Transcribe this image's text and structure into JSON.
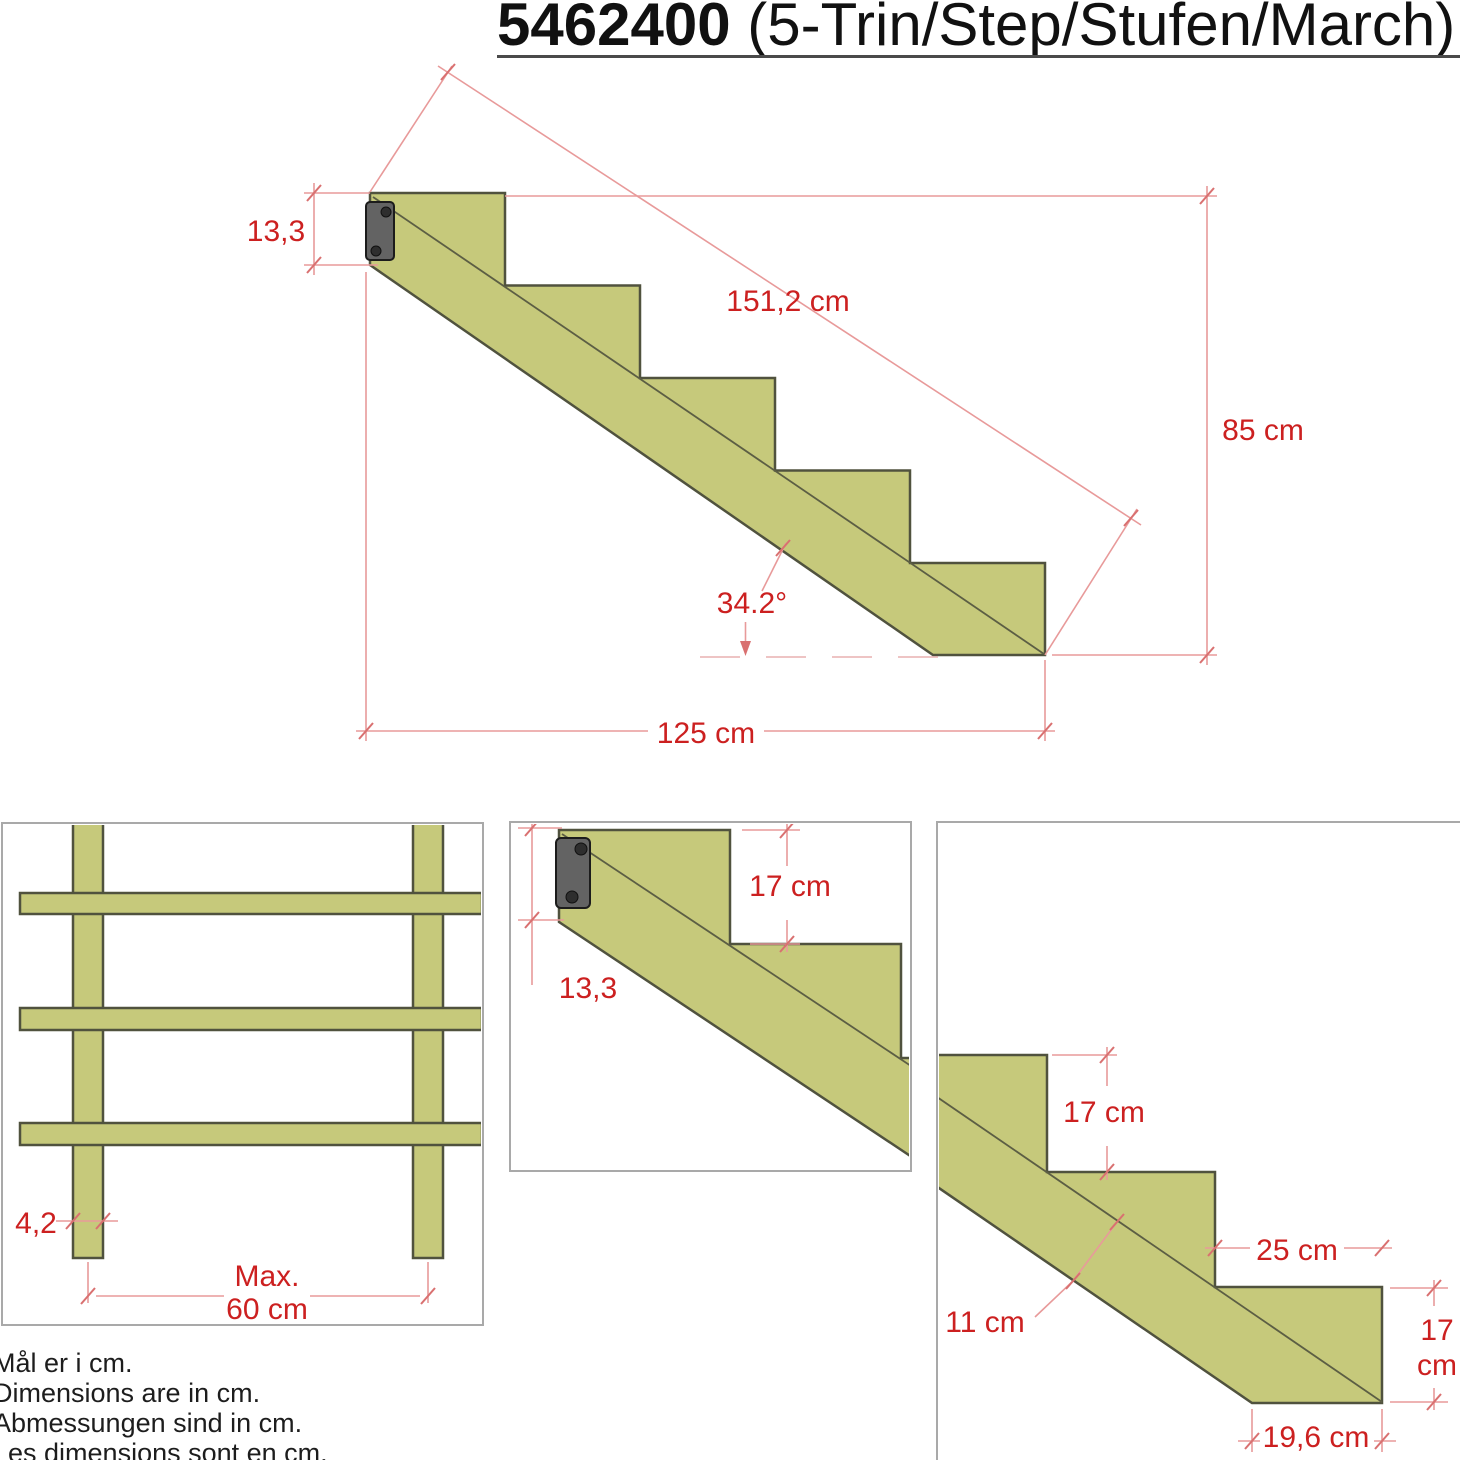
{
  "title": {
    "code": "5462400",
    "variant": " (5-Trin/Step/Stufen/March)"
  },
  "main_view": {
    "bracket_offset": "13,3",
    "slope_length": "151,2 cm",
    "total_height": "85 cm",
    "angle": "34.2°",
    "total_run": "125 cm"
  },
  "front_view": {
    "stringer_thickness": "4,2",
    "spacing_label": "Max.",
    "spacing_value": "60 cm"
  },
  "top_detail": {
    "rise": "17 cm",
    "bracket_offset": "13,3"
  },
  "corner_detail": {
    "rise": "17 cm",
    "tread_depth": "25 cm",
    "stringer_depth": "11 cm",
    "rise_right_value": "17",
    "rise_right_unit": "cm",
    "bottom_run": "19,6 cm"
  },
  "notes": {
    "lines": [
      "Mål er i cm.",
      "Dimensions are in cm.",
      "Abmessungen sind in cm.",
      "Les dimensions sont en cm."
    ]
  },
  "colors": {
    "wood_fill": "#c6c97b",
    "wood_outline": "#50523e",
    "dimension_text": "#cc2020",
    "dimension_line": "#e89a9a",
    "bracket_fill": "#636363",
    "box_border": "#a9a9a9"
  }
}
